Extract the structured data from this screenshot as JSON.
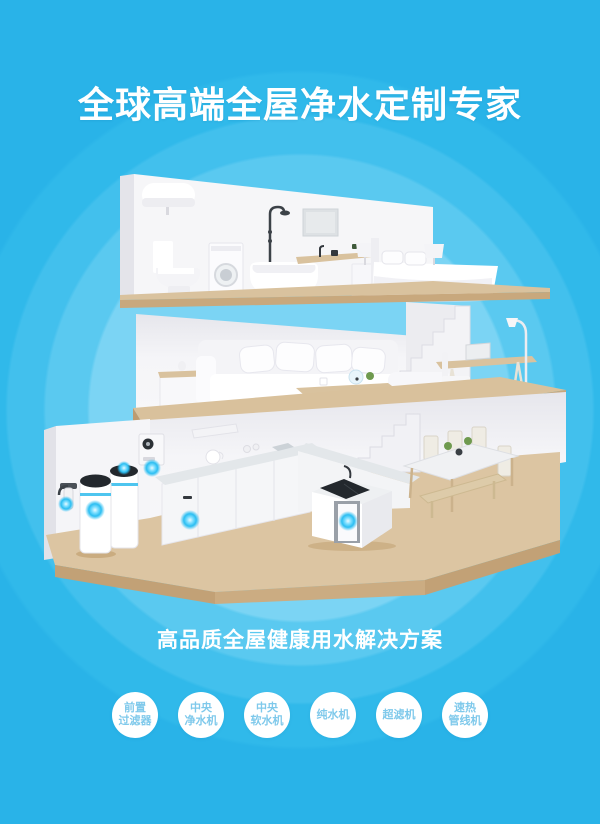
{
  "header": {
    "title": "全球高端全屋净水定制专家"
  },
  "tagline": {
    "text": "高品质全屋健康用水解决方案"
  },
  "badges": [
    {
      "line1": "前置",
      "line2": "过滤器"
    },
    {
      "line1": "中央",
      "line2": "净水机"
    },
    {
      "line1": "中央",
      "line2": "软水机"
    },
    {
      "line1": "纯水机"
    },
    {
      "line1": "超滤机"
    },
    {
      "line1": "速热",
      "line2": "管线机"
    }
  ],
  "illustration": {
    "description": "three-story cutaway house with whole-house water purification points",
    "floors": [
      "bathroom-bedroom",
      "living-room",
      "kitchen-dining"
    ],
    "devices": [
      "pre-filter",
      "central-purifier-tank",
      "central-softener-tank",
      "wall-purifier-box",
      "under-counter-purifier",
      "island-under-sink-purifier"
    ],
    "glow_dot_count": 6
  },
  "colors": {
    "background_blue": "#29b3e8",
    "ripple_inner": "#7bd4f4",
    "badge_text_blue": "#7fc9eb",
    "glow_cyan": "#31c3f3",
    "wood_top": "#d9c19c",
    "wood_front": "#c8a87d",
    "wall_white": "#f6f6f8",
    "title_white": "#ffffff"
  }
}
